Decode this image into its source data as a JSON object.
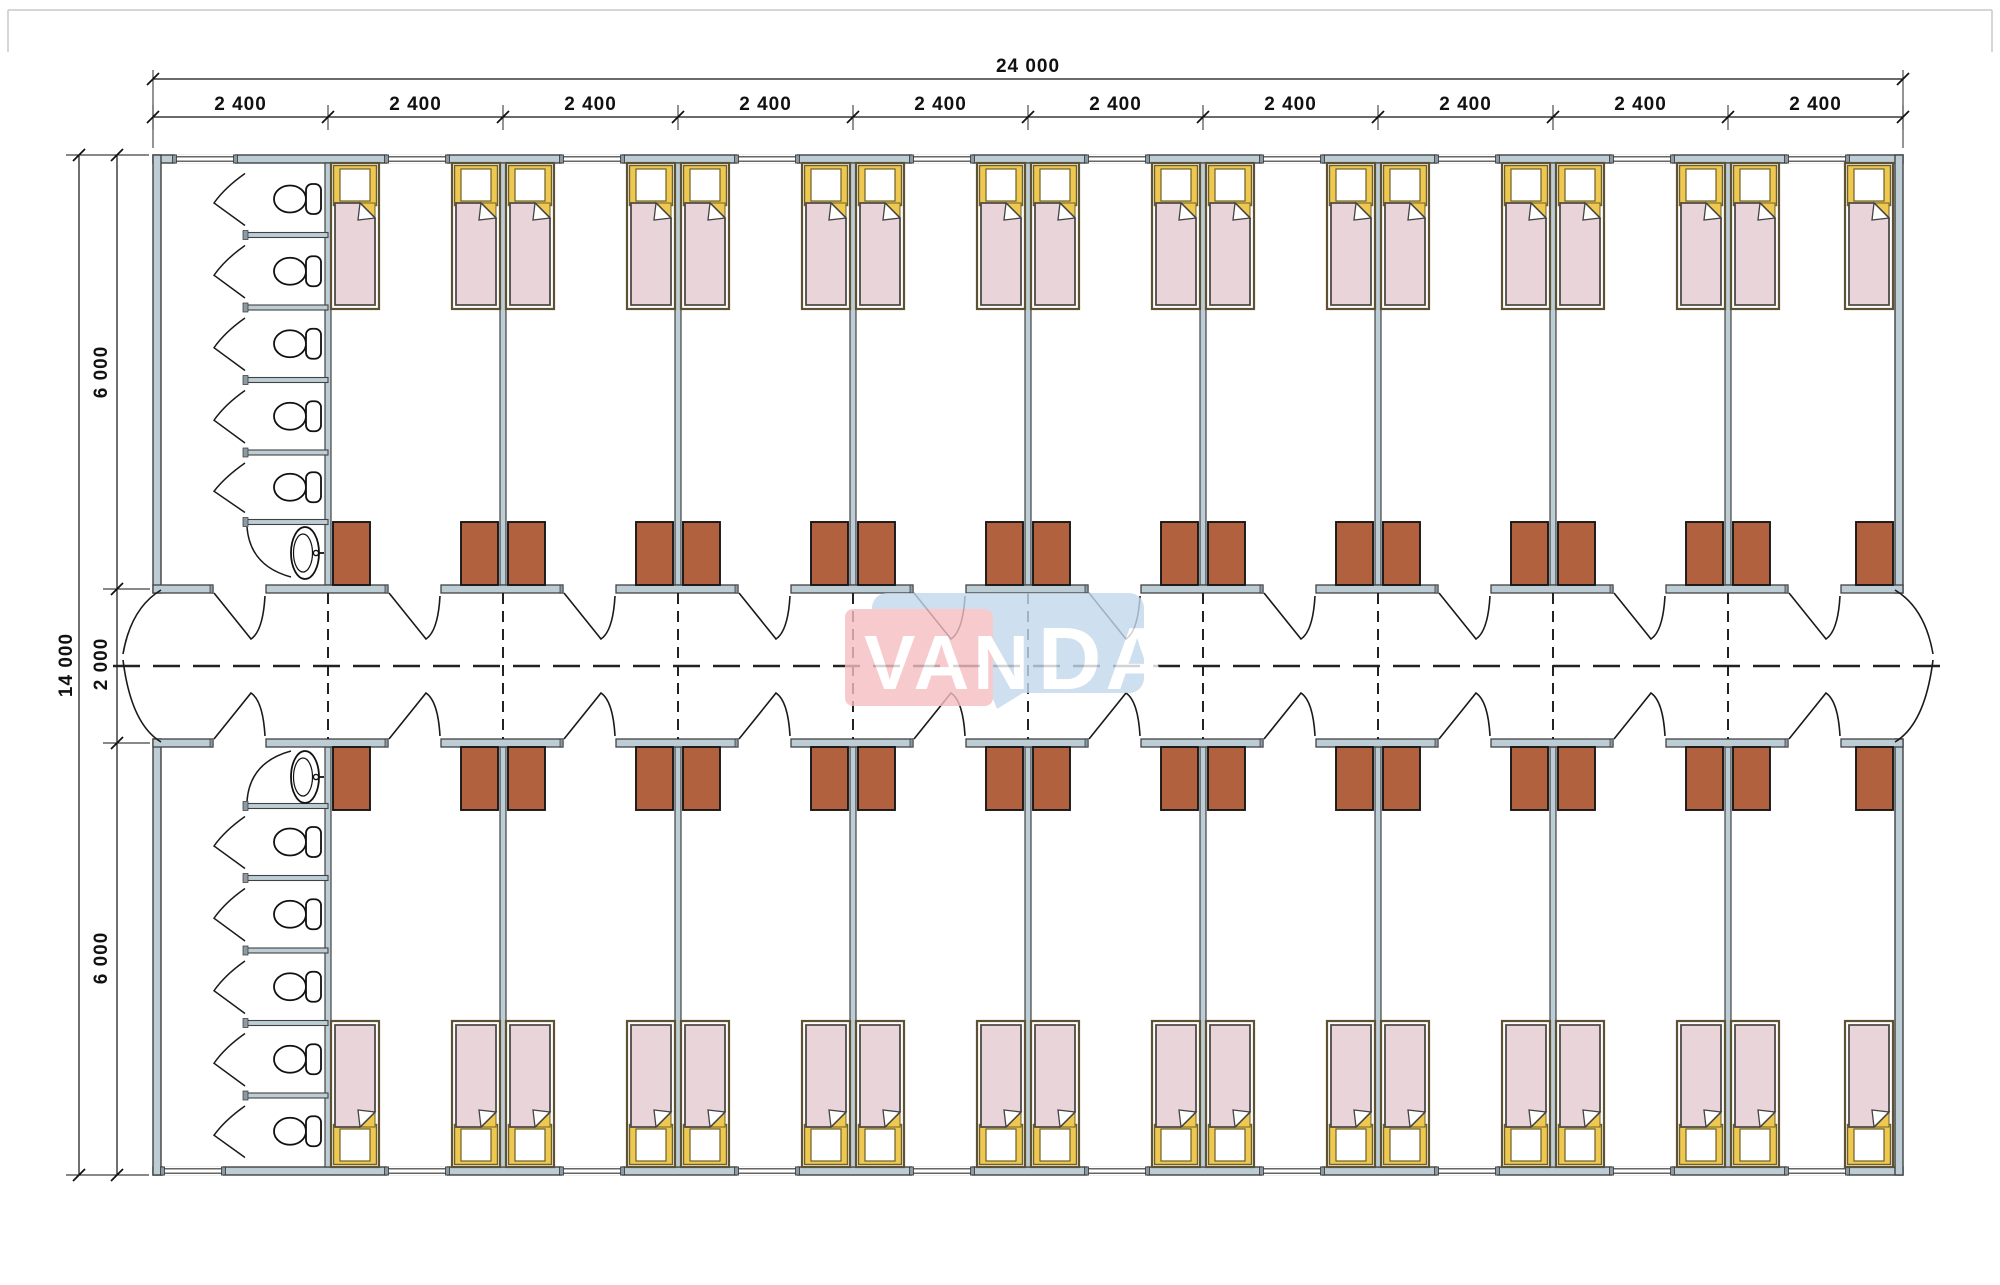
{
  "drawing": {
    "type": "floor-plan",
    "description": "Dormitory container building plan: two rows of bedrooms with beds and wardrobes, WC stall block at left, central corridor"
  },
  "dimensions": {
    "top_total": "24 000",
    "top_segments": [
      "2 400",
      "2 400",
      "2 400",
      "2 400",
      "2 400",
      "2 400",
      "2 400",
      "2 400",
      "2 400",
      "2 400"
    ],
    "left_total": "14 000",
    "left_segments": [
      "6 000",
      "2 000",
      "6 000"
    ]
  },
  "watermark": {
    "text_left": "VAN",
    "text_right": "DA",
    "pink": "#f6bec2",
    "blue": "#c3d8ec",
    "text_color": "#ffffff"
  },
  "colors": {
    "wall_fill": "#bccdd6",
    "wall_stroke": "#424242",
    "jamb_fill": "#8d9aa3",
    "line": "#1a1a1a",
    "bed_frame_fill": "#ffffff",
    "bed_frame_stroke": "#5e5233",
    "mattress_fill": "#e8d4d9",
    "mattress_stroke": "#4f4b45",
    "pillow_fill": "#ffffff",
    "blanket_yellow": "#eec851",
    "yellow_stroke": "#6e6027",
    "cabinet_fill": "#b2613e",
    "cabinet_stroke": "#181818",
    "fixture_stroke": "#111111",
    "dash_color": "#222222",
    "dim_color": "#111111",
    "frame_line": "#c9c9c9"
  },
  "layout": {
    "left": 153,
    "right": 1903,
    "top": 155,
    "bottom": 1175,
    "bays": 10,
    "bay_width": 175,
    "wall_thickness": 8,
    "partition_thickness": 6,
    "corridor_wall_top": 585,
    "corridor_wall_bottom": 739,
    "door_offset": 60,
    "door_width": 53,
    "window_offset": 59,
    "window_offset_first_bay": 22,
    "window_width": 60,
    "bed_width": 48,
    "bed_height": 146,
    "cabinet_width": 37,
    "cabinet_height": 63,
    "stall_left": 245,
    "stall_right": 325,
    "stall_count": 5
  },
  "fixtures": {
    "beds": 36,
    "wardrobes": 36,
    "toilets": 10,
    "sinks": 2,
    "corridor_doors": 20,
    "stall_doors": 10,
    "windows": 20
  }
}
